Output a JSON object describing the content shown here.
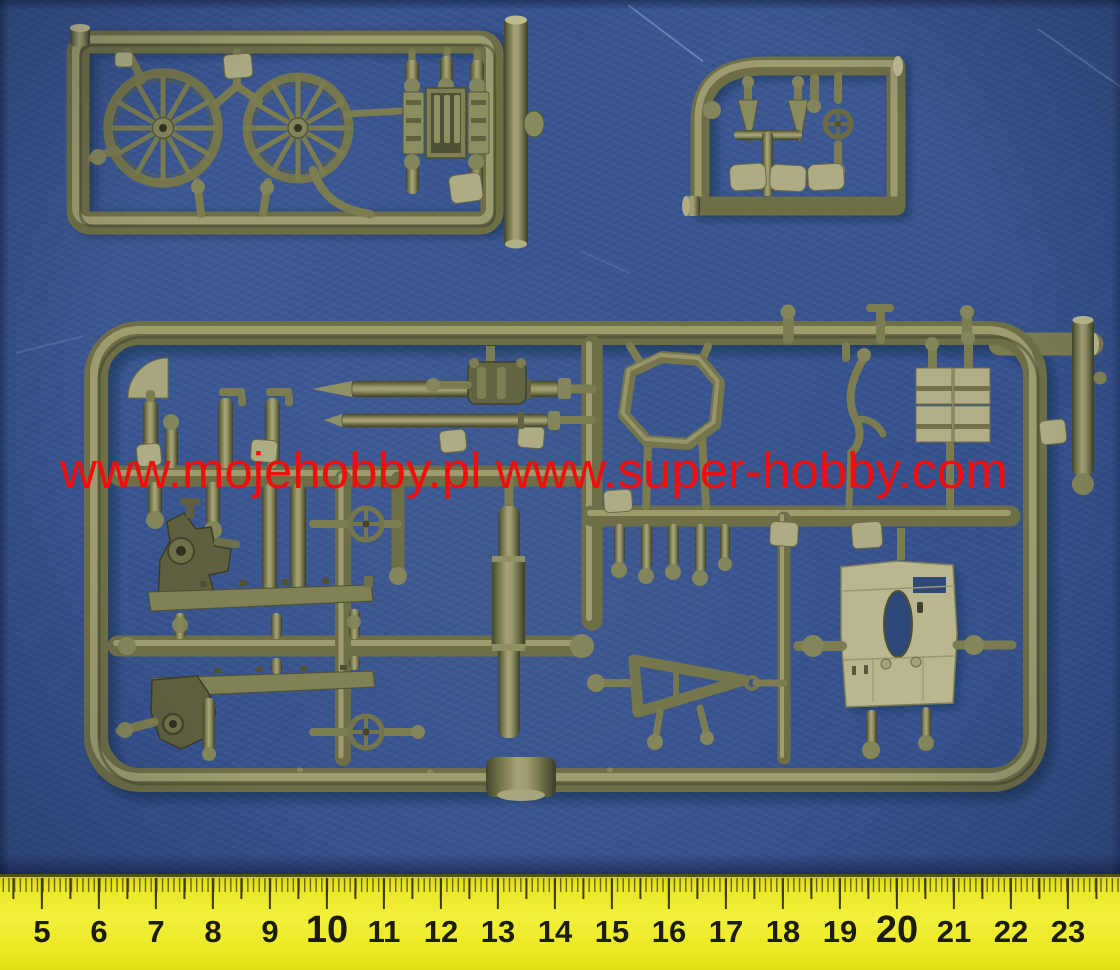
{
  "photo": {
    "subject": "Olive-green injection moulded model kit sprues photographed on a blue textured background with a centimetre ruler",
    "background_color": "#35518c",
    "plastic_color": "#7b7c50",
    "plastic_highlight_color": "#a6a477",
    "light_part_color": "#b2af89",
    "dark_part_color": "#5d5f3e"
  },
  "watermark": {
    "text": "www.mojehobby.pl www.super-hobby.com",
    "color": "#f20d0d"
  },
  "sprues": [
    {
      "id": "wheel-sprue",
      "description": "small rectangular sprue with two spoked wagon wheels and an ammunition crate"
    },
    {
      "id": "small-parts-sprue",
      "description": "small sprue with two seats-and-cones group, handwheel and three seat pads"
    },
    {
      "id": "main-sprue",
      "description": "large sprue with gun barrel, shield plate, carriage trails, two shells, ammo boxes, octagonal frame and handwheels"
    }
  ],
  "ruler": {
    "color": "#ece923",
    "tick_color": "#3c3c14",
    "number_color": "#1c1c0e",
    "labels": [
      "5",
      "6",
      "7",
      "8",
      "9",
      "10",
      "11",
      "12",
      "13",
      "14",
      "15",
      "16",
      "17",
      "18",
      "19",
      "20",
      "21",
      "22",
      "23"
    ],
    "emphasized_labels": [
      "10",
      "20"
    ]
  }
}
